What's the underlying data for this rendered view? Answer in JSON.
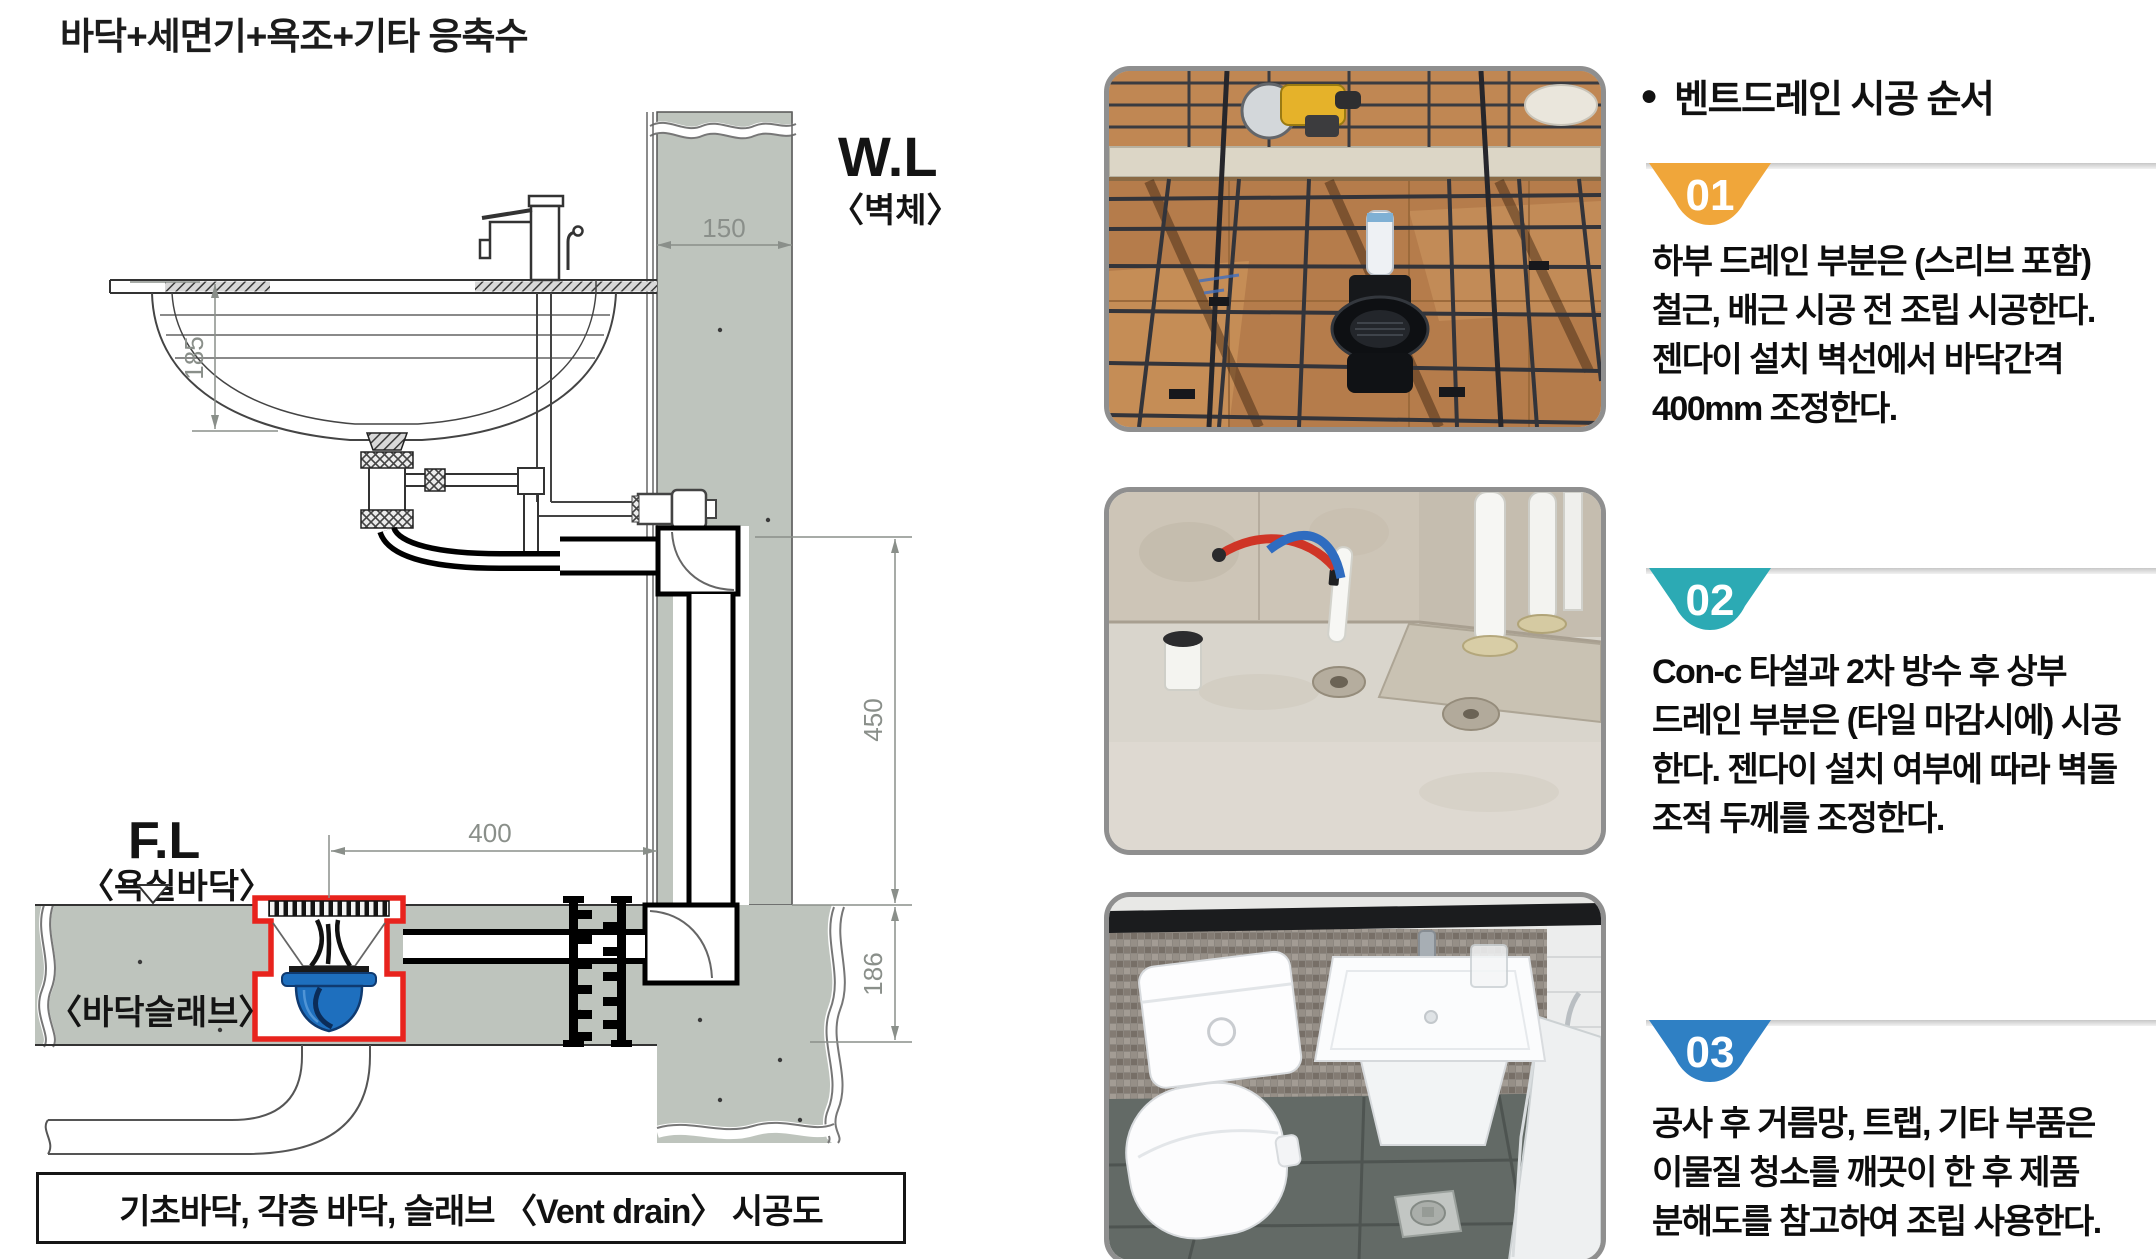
{
  "page": {
    "title": "바닥+세면기+욕조+기타 응축수"
  },
  "diagram": {
    "caption": "기초바닥, 각층 바닥, 슬래브 〈Vent drain〉 시공도",
    "labels": {
      "wall_level": "W.L",
      "wall_level_sub": "〈벽체〉",
      "floor_level": "F.L",
      "floor_level_sub": "〈욕실바닥〉",
      "floor_slab": "〈바닥슬래브〉"
    },
    "dimensions": {
      "wall_thickness": "150",
      "basin_depth": "185",
      "riser_height": "450",
      "drain_to_wall": "400",
      "slab_thickness": "186"
    },
    "colors": {
      "concrete_gray": "#bec4bd",
      "drain_highlight_red": "#e8231d",
      "trap_blue": "#1e6fbe"
    }
  },
  "steps_panel": {
    "heading_bullet": "●",
    "heading": "벤트드레인 시공 순서",
    "steps": [
      {
        "number": "01",
        "badge_color": "#f0a63a",
        "photo": "rebar-formwork-drain-photo",
        "text": "하부 드레인 부분은 (스리브 포함)\n철근, 배근 시공 전 조립 시공한다.\n젠다이 설치 벽선에서 바닥간격\n400mm 조정한다."
      },
      {
        "number": "02",
        "badge_color": "#2caab4",
        "photo": "concrete-floor-piping-photo",
        "text": "Con-c 타설과 2차 방수 후 상부\n드레인 부분은 (타일 마감시에) 시공\n한다. 젠다이 설치 여부에 따라 벽돌\n조적 두께를 조정한다."
      },
      {
        "number": "03",
        "badge_color": "#2f80c4",
        "photo": "finished-bathroom-photo",
        "text": "공사 후 거름망, 트랩, 기타 부품은\n이물질 청소를 깨끗이 한 후 제품\n분해도를 참고하여 조립 사용한다."
      }
    ]
  }
}
